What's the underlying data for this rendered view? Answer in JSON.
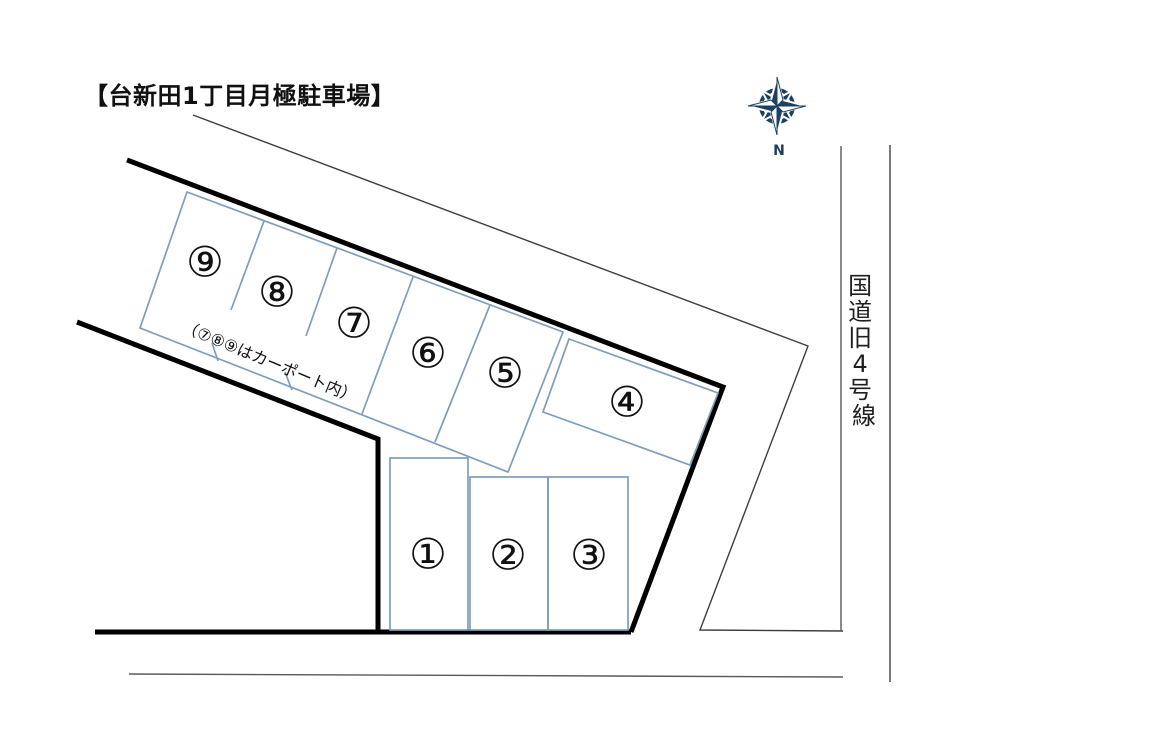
{
  "diagram": {
    "title": "【台新田1丁目月極駐車場】",
    "note": "（⑦⑧⑨はカーポート内）",
    "north_label": "N",
    "road": {
      "name": "国道旧4号線",
      "chars": [
        "国",
        "道",
        "旧",
        "4",
        "号",
        "線"
      ]
    },
    "spaces": [
      {
        "num": "1",
        "label": "①"
      },
      {
        "num": "2",
        "label": "②"
      },
      {
        "num": "3",
        "label": "③"
      },
      {
        "num": "4",
        "label": "④"
      },
      {
        "num": "5",
        "label": "⑤"
      },
      {
        "num": "6",
        "label": "⑥"
      },
      {
        "num": "7",
        "label": "⑦"
      },
      {
        "num": "8",
        "label": "⑧"
      },
      {
        "num": "9",
        "label": "⑨"
      }
    ]
  },
  "colors": {
    "boundary": "#000000",
    "parking_line": "#7f9db9",
    "property_line": "#3d3d3d",
    "road_line": "#595959",
    "road_line_dark": "#404040",
    "compass": "#1c4060",
    "text": "#111111"
  }
}
